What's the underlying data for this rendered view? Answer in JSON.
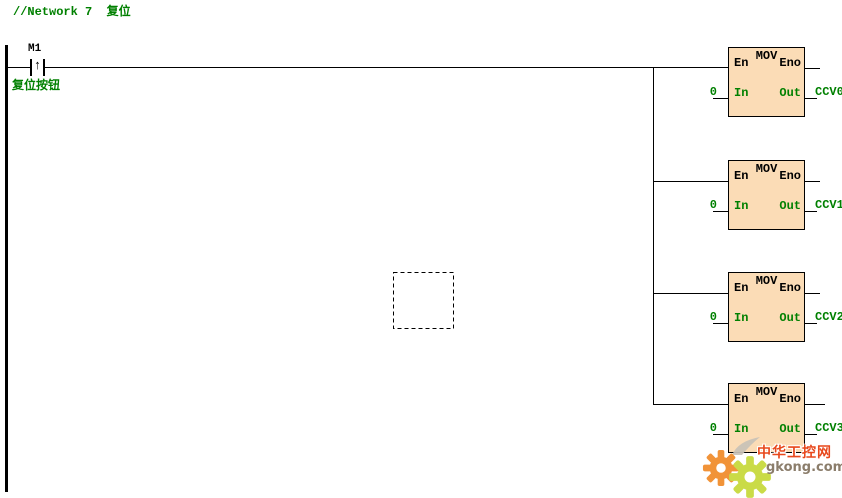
{
  "network": {
    "comment": "//Network 7  复位"
  },
  "contact": {
    "label": "M1",
    "edge_symbol": "↑",
    "comment": "复位按钮"
  },
  "blocks": [
    {
      "title": "MOV",
      "pin_en": "En",
      "pin_eno": "Eno",
      "pin_in": "In",
      "pin_out": "Out",
      "input_value": "0",
      "output_operand": "CCV0"
    },
    {
      "title": "MOV",
      "pin_en": "En",
      "pin_eno": "Eno",
      "pin_in": "In",
      "pin_out": "Out",
      "input_value": "0",
      "output_operand": "CCV1"
    },
    {
      "title": "MOV",
      "pin_en": "En",
      "pin_eno": "Eno",
      "pin_in": "In",
      "pin_out": "Out",
      "input_value": "0",
      "output_operand": "CCV2"
    },
    {
      "title": "MOV",
      "pin_en": "En",
      "pin_eno": "Eno",
      "pin_in": "In",
      "pin_out": "Out",
      "input_value": "0",
      "output_operand": "CCV3"
    }
  ],
  "watermark": {
    "title": "中华工控网",
    "site": "gkong.com"
  },
  "colors": {
    "comment_green": "#008000",
    "block_fill": "#FBDCB6",
    "block_border": "#000000",
    "wire": "#000000",
    "watermark_gear_orange": "#F08A28",
    "watermark_gear_green": "#C6D938",
    "watermark_title_red": "#E8481C",
    "watermark_site_gray": "#8B7D6B"
  }
}
